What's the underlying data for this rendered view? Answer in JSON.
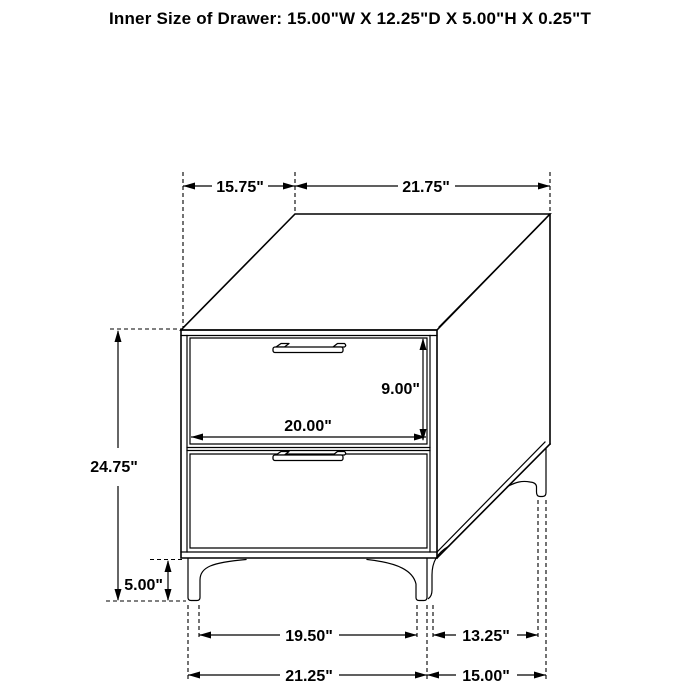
{
  "title": "Inner Size of Drawer: 15.00\"W X 12.25\"D X 5.00\"H X 0.25\"T",
  "dimensions": {
    "top_depth": "15.75\"",
    "top_width": "21.75\"",
    "overall_height": "24.75\"",
    "leg_height": "5.00\"",
    "drawer_opening_height": "9.00\"",
    "drawer_front_width": "20.00\"",
    "front_leg_inner_span": "19.50\"",
    "side_leg_span": "13.25\"",
    "base_front_width": "21.25\"",
    "base_side_depth": "15.00\""
  },
  "colors": {
    "line": "#000000",
    "text": "#000000",
    "background": "#ffffff"
  }
}
